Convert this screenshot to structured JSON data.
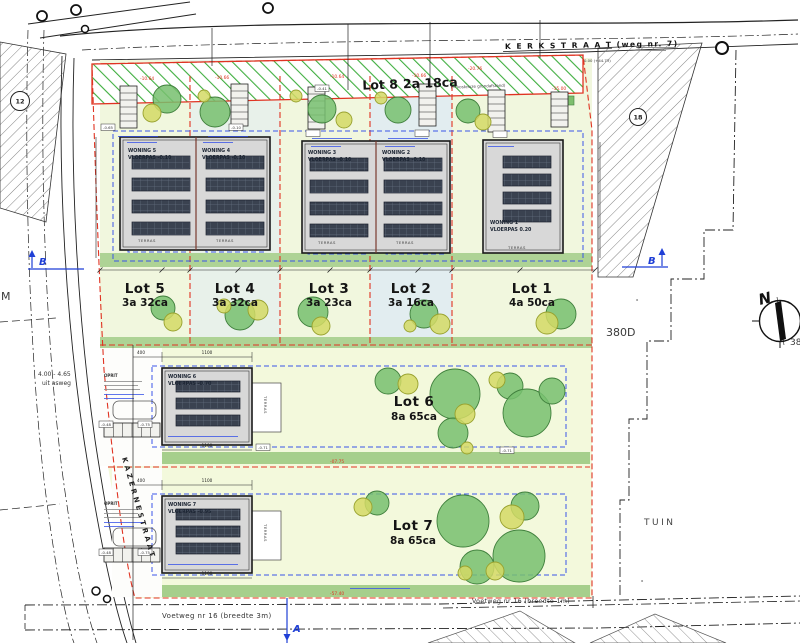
{
  "streets": {
    "kerkstraat": "K E R K S T R A A T  (weg nr. 7)",
    "kazernestraat": "KAZERNESTRAAT",
    "voetweg_3m": "Voetweg nr 16 (breedte 3m)",
    "voetweg_1m": "Voetweg nr 16 (breedte 1m)",
    "benchmark": "0.00 (+44.73)"
  },
  "lots": {
    "lot8": {
      "name": "Lot 8",
      "area": "2a 18ca",
      "note": "(= kosteloze grondafstand)"
    },
    "lot5": {
      "name": "Lot 5",
      "area": "3a 32ca"
    },
    "lot4": {
      "name": "Lot 4",
      "area": "3a 32ca"
    },
    "lot3": {
      "name": "Lot 3",
      "area": "3a 23ca"
    },
    "lot2": {
      "name": "Lot 2",
      "area": "3a 16ca"
    },
    "lot1": {
      "name": "Lot 1",
      "area": "4a 50ca"
    },
    "lot6": {
      "name": "Lot 6",
      "area": "8a 65ca"
    },
    "lot7": {
      "name": "Lot 7",
      "area": "8a 65ca"
    }
  },
  "houses": {
    "w5": {
      "name": "WONING 5",
      "level": "VLOERPAS -0.10"
    },
    "w4": {
      "name": "WONING 4",
      "level": "VLOERPAS -0.10"
    },
    "w3": {
      "name": "WONING 3",
      "level": "VLOERPAS -0.10"
    },
    "w2": {
      "name": "WONING 2",
      "level": "VLOERPAS -0.10"
    },
    "w1": {
      "name": "WONING 1",
      "level": "VLOERPAS 0.20"
    },
    "w6": {
      "name": "WONING 6",
      "level": "VLOERPAS -0.70"
    },
    "w7": {
      "name": "WONING 7",
      "level": "VLOERPAS -0.95"
    }
  },
  "markers": {
    "a": "A",
    "b": "B",
    "north": "N"
  },
  "labels": {
    "parcel_380d": "380D",
    "parcel_partial": "38",
    "tuin": "TUIN",
    "m": "M",
    "asweg1": "4.00 - 4.65",
    "asweg2": "uit asweg",
    "oprit": "OPRIT",
    "terras": "TERRAS",
    "circle12": "12",
    "circle18": "18",
    "spot_x": "x"
  },
  "dims": {
    "d1100": "1100",
    "d400": "400"
  },
  "red_dims": {
    "r1": "-10.64",
    "r2": "-10.66",
    "r3": "-15.00",
    "r4": "-20.76",
    "r5": "-07.75",
    "r6": "-57.40"
  },
  "spots": {
    "s065": "-0.65",
    "s010": "-0.10",
    "s041": "-0.41",
    "s048": "-0.48",
    "s075": "-0.75",
    "s071": "-0.71"
  },
  "colors": {
    "boundary_red": "#e03322",
    "envelope_blue": "#3a55e8",
    "marker_blue": "#1f3fd6",
    "lot_green": "#f1f7de",
    "lot_blue_tint": "#e2edf0",
    "lot_big_green": "#f3f9dc",
    "hedge_green": "#aed395",
    "tree_green": "#77c06e",
    "tree_yellow": "#d3d965",
    "house_grey": "#d8d8d8",
    "panel_dark": "#3a4250",
    "hatch_green": "#3fae3f"
  }
}
